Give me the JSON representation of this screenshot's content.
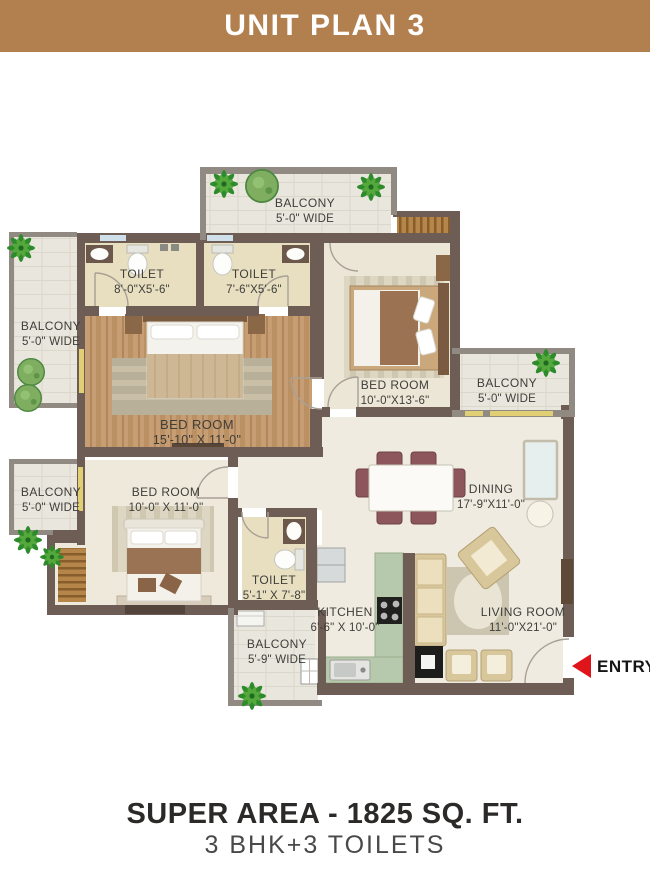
{
  "header": {
    "title": "UNIT PLAN 3"
  },
  "rooms": [
    {
      "name": "BALCONY",
      "dims": "5'-0\" WIDE"
    },
    {
      "name": "TOILET",
      "dims": "8'-0\"X5'-6\""
    },
    {
      "name": "TOILET",
      "dims": "7'-6\"X5'-6\""
    },
    {
      "name": "BALCONY",
      "dims": "5'-0\" WIDE"
    },
    {
      "name": "BED ROOM",
      "dims": "15'-10\" X 11'-0\""
    },
    {
      "name": "BED ROOM",
      "dims": "10'-0\"X13'-6\""
    },
    {
      "name": "BALCONY",
      "dims": "5'-0\" WIDE"
    },
    {
      "name": "BALCONY",
      "dims": "5'-0\" WIDE"
    },
    {
      "name": "BED ROOM",
      "dims": "10'-0\" X 11'-0\""
    },
    {
      "name": "DINING",
      "dims": "17'-9\"X11'-0\""
    },
    {
      "name": "TOILET",
      "dims": "5'-1\" X 7'-8\""
    },
    {
      "name": "KITCHEN",
      "dims": "6'-6\" X 10'-0\""
    },
    {
      "name": "BALCONY",
      "dims": "5'-9\" WIDE"
    },
    {
      "name": "LIVING ROOM",
      "dims": "11'-0\"X21'-0\""
    }
  ],
  "entry": {
    "label": "ENTRY"
  },
  "footer": {
    "line1": "SUPER AREA - 1825 SQ. FT.",
    "line2": "3 BHK+3 TOILETS"
  },
  "colors": {
    "banner": "#b2804e",
    "wall": "#6d5d55",
    "entry_red": "#e0151b",
    "kitchen_counter": "#b7c9ac",
    "plant_green": "#2e8b2b"
  }
}
